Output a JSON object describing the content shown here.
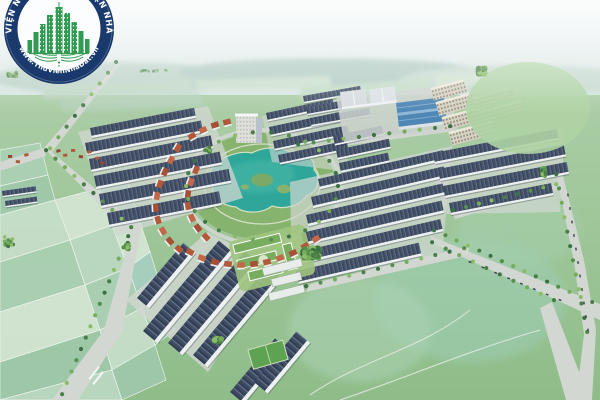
{
  "image": {
    "type": "aerial-3d-architectural-render",
    "description": "Bird's-eye 3D rendering of a master-planned residential township: long rows of white shophouses with dark slate roofs, orange-roofed villas curving around a central turquoise lake park, a blue-roofed factory hall with white warehouses, beige apartment slabs, an office tower, tree-lined boulevards and pale-green patchwork farmland stretching to a hazy horizon."
  },
  "watermark": {
    "ring_text_top": "THƯ VIỆN NHÀ ĐẤT · THƯ VIỆN NHÀ ĐẤT",
    "ring_text_bottom": "✦ www.ThuVienNhaDat.vn ✦",
    "emblem_icon": "green-city-skyline-with-wings",
    "colors": {
      "ring": "#16366b",
      "inner_disc": "#fdfeff",
      "emblem_green": "#2f9a50",
      "text": "#ffffff"
    }
  },
  "scene": {
    "colors": {
      "sky_top": "#edf3f4",
      "sky_horizon": "#cfe0db",
      "haze": "#e3ece9",
      "ground_near": "#8fbc89",
      "ground_far": "#abcda6",
      "field_pale": "#d2e5d4",
      "field_teal": "#a6cfc0",
      "lake_water": "#2ea79a",
      "lake_light": "#49b7a8",
      "park_green": "#86b36e",
      "roof_dark": "#46536a",
      "roof_orange": "#b3593b",
      "factory_blue": "#4e86b4",
      "facade_white": "#eef1f2",
      "road_gray": "#d2d7d1",
      "apartment_beige": "#d8d3c3",
      "tree_dark": "#3a7243",
      "tree_mid": "#558f4e",
      "tree_light": "#74ac5c"
    }
  }
}
